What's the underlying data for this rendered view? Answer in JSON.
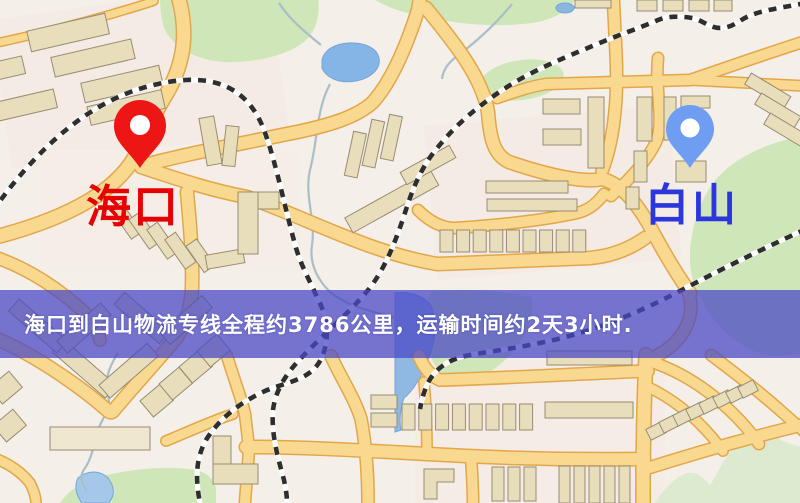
{
  "map": {
    "origin": {
      "label": "海口",
      "label_color": "#e60000",
      "pin_color": "#ee1515"
    },
    "destination": {
      "label": "白山",
      "label_color": "#2b36dd",
      "pin_color": "#6f9df2"
    },
    "banner": {
      "text": "海口到白山物流专线全程约3786公里，运输时间约2天3小时.",
      "background": "rgba(73,71,197,0.74)",
      "text_color": "#ffffff"
    },
    "palette": {
      "background": "#f4efe8",
      "road_fill": "#f8d98f",
      "road_casing": "#e3a64b",
      "building": "#e9debc",
      "green_area": "#cfe6b8",
      "pale_green": "#dcead0",
      "water": "#84b5e6",
      "railway_dash": "#2e2e2e",
      "stream": "#a8bfc6"
    }
  }
}
